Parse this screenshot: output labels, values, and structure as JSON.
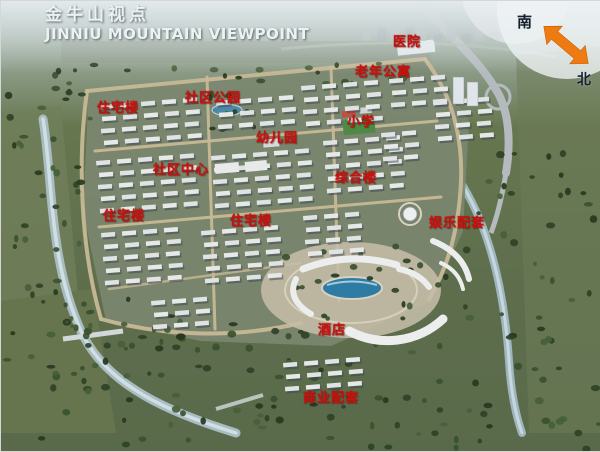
{
  "title": {
    "zh": "金牛山视点",
    "en": "JINNIU MOUNTAIN VIEWPOINT"
  },
  "compass": {
    "south_label": "南",
    "north_label": "北"
  },
  "map_labels": [
    {
      "id": "hospital",
      "text": "医院",
      "x": 392,
      "y": 30
    },
    {
      "id": "senior-apartments",
      "text": "老年公寓",
      "x": 354,
      "y": 60
    },
    {
      "id": "residential-1",
      "text": "住宅楼",
      "x": 96,
      "y": 96
    },
    {
      "id": "community-park",
      "text": "社区公园",
      "x": 184,
      "y": 86
    },
    {
      "id": "primary-school",
      "text": "小学",
      "x": 346,
      "y": 110
    },
    {
      "id": "kindergarten",
      "text": "幼儿园",
      "x": 255,
      "y": 126
    },
    {
      "id": "community-center",
      "text": "社区中心",
      "x": 152,
      "y": 158
    },
    {
      "id": "mixed-use-building",
      "text": "综合楼",
      "x": 334,
      "y": 166
    },
    {
      "id": "residential-2",
      "text": "住宅楼",
      "x": 102,
      "y": 204
    },
    {
      "id": "residential-3",
      "text": "住宅楼",
      "x": 229,
      "y": 209
    },
    {
      "id": "entertainment-facilities",
      "text": "娱乐配套",
      "x": 428,
      "y": 211
    },
    {
      "id": "hotel",
      "text": "酒店",
      "x": 317,
      "y": 318
    },
    {
      "id": "commercial-facilities",
      "text": "商业配套",
      "x": 302,
      "y": 386
    }
  ],
  "colors": {
    "label_red": "#c9120e",
    "title_white": "#ecf1f2",
    "compass_orange": "#ee7b12",
    "pond_blue": "#2e7ca4"
  }
}
